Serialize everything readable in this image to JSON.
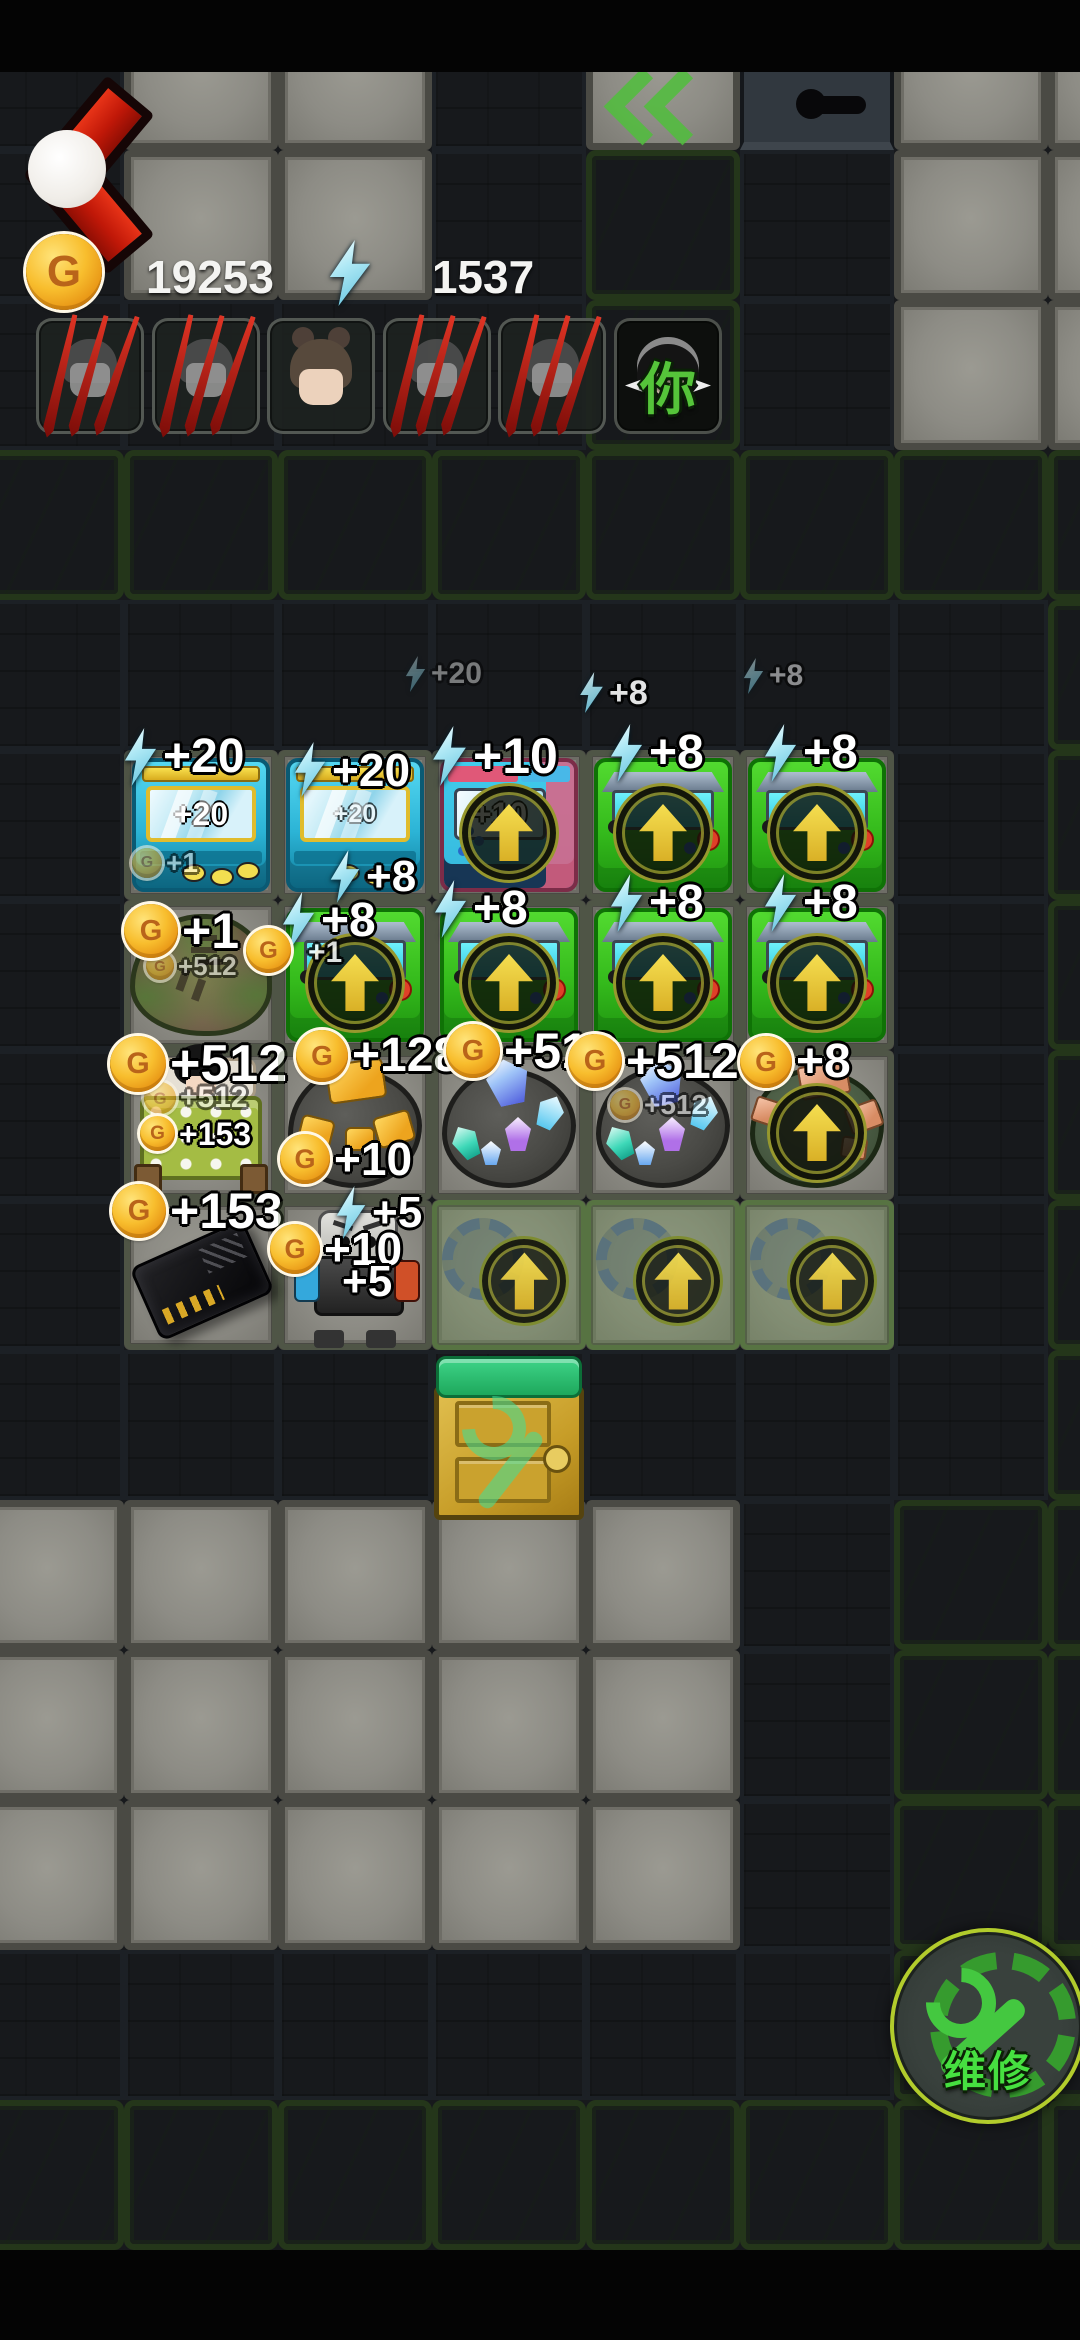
{
  "icons": {
    "coin_letter": "G"
  },
  "hud": {
    "coins": "19253",
    "energy": "1537"
  },
  "party": {
    "you_label": "你",
    "slots": [
      {
        "avatar": "ghost",
        "defeated": true
      },
      {
        "avatar": "ghost",
        "defeated": true
      },
      {
        "avatar": "girl",
        "defeated": false
      },
      {
        "avatar": "ghost",
        "defeated": true
      },
      {
        "avatar": "ghost",
        "defeated": true
      },
      {
        "avatar": "you",
        "defeated": false
      }
    ]
  },
  "map": {
    "tile_w": 154,
    "tile_h": 150,
    "origin_x": -30,
    "origin_y": 0,
    "rows": [
      "DLLDXVLL",
      "DLLDGDLL",
      "DDDDGDLL",
      "GGGGGGGG",
      "DDDDDDDG",
      "DLLLLLDG",
      "DLLLLLDG",
      "DLLLLLDG",
      "DLLLLLDG",
      "DDDDDDDG",
      "LLLLLDGG",
      "LLLLLDGG",
      "LLLLLDGG",
      "DDDDDDGG",
      "GGGGGGGG",
      "BBBBBBBB"
    ]
  },
  "grid": {
    "cells": [
      {
        "row": 1,
        "col": 1,
        "item": "arcade-cyan",
        "screen": "+20",
        "arrow": false,
        "ghost": false,
        "labels": [
          {
            "icon": "energy",
            "text": "+20",
            "dx": -2,
            "dy": -22,
            "size": 48
          }
        ],
        "overlays": [
          {
            "icon": "coin",
            "text": "+1",
            "dx": 8,
            "dy": 98,
            "size": 28,
            "faint": true
          }
        ]
      },
      {
        "row": 1,
        "col": 2,
        "item": "arcade-cyan",
        "screen": "+20",
        "screen_faint": true,
        "arrow": false,
        "ghost": false,
        "labels": [
          {
            "icon": "energy",
            "text": "+20",
            "dx": 14,
            "dy": -8,
            "size": 46
          },
          {
            "icon": "energy",
            "text": "+8",
            "dx": 50,
            "dy": 100,
            "size": 44
          }
        ],
        "overlays": []
      },
      {
        "row": 1,
        "col": 3,
        "item": "arcade-pink",
        "screen": "+10",
        "arrow": true,
        "ghost": false,
        "labels": [
          {
            "icon": "energy",
            "text": "+10",
            "dx": -2,
            "dy": -24,
            "size": 50
          }
        ],
        "overlays": []
      },
      {
        "row": 1,
        "col": 4,
        "item": "arcade-green",
        "arrow": true,
        "ghost": false,
        "labels": [
          {
            "icon": "energy",
            "text": "+8",
            "dx": 22,
            "dy": -26,
            "size": 48
          }
        ],
        "overlays": []
      },
      {
        "row": 1,
        "col": 5,
        "item": "arcade-green",
        "arrow": true,
        "ghost": false,
        "labels": [
          {
            "icon": "energy",
            "text": "+8",
            "dx": 22,
            "dy": -26,
            "size": 48
          }
        ],
        "overlays": []
      },
      {
        "row": 2,
        "col": 1,
        "item": "stump",
        "arrow": false,
        "ghost": false,
        "labels": [
          {
            "icon": "coin",
            "text": "+1",
            "dx": 0,
            "dy": 4,
            "size": 50
          }
        ],
        "overlays": [
          {
            "icon": "coin",
            "text": "+512",
            "dx": 22,
            "dy": 52,
            "size": 26,
            "faint": true
          }
        ]
      },
      {
        "row": 2,
        "col": 2,
        "item": "arcade-green",
        "arrow": true,
        "ghost": false,
        "labels": [
          {
            "icon": "energy",
            "text": "+8",
            "dx": 2,
            "dy": -8,
            "size": 48
          }
        ],
        "overlays": []
      },
      {
        "row": 2,
        "col": 3,
        "item": "arcade-green",
        "arrow": true,
        "ghost": false,
        "labels": [
          {
            "icon": "energy",
            "text": "+8",
            "dx": 0,
            "dy": -20,
            "size": 48
          }
        ],
        "overlays": []
      },
      {
        "row": 2,
        "col": 4,
        "item": "arcade-green",
        "arrow": true,
        "ghost": false,
        "labels": [
          {
            "icon": "energy",
            "text": "+8",
            "dx": 22,
            "dy": -26,
            "size": 48
          }
        ],
        "overlays": []
      },
      {
        "row": 2,
        "col": 5,
        "item": "arcade-green",
        "arrow": true,
        "ghost": false,
        "labels": [
          {
            "icon": "energy",
            "text": "+8",
            "dx": 22,
            "dy": -26,
            "size": 48
          }
        ],
        "overlays": []
      },
      {
        "row": 3,
        "col": 1,
        "item": "bed",
        "arrow": false,
        "ghost": false,
        "labels": [
          {
            "icon": "coin",
            "text": "+512",
            "dx": -14,
            "dy": -14,
            "size": 52
          }
        ],
        "overlays": [
          {
            "icon": "coin",
            "text": "+512",
            "dx": 20,
            "dy": 32,
            "size": 30,
            "faint": true
          },
          {
            "icon": "coin",
            "text": "+153",
            "dx": 16,
            "dy": 66,
            "size": 32
          }
        ]
      },
      {
        "row": 3,
        "col": 2,
        "item": "gold-rock",
        "arrow": false,
        "ghost": false,
        "labels": [
          {
            "icon": "coin",
            "text": "+128",
            "dx": 18,
            "dy": -20,
            "size": 48
          },
          {
            "icon": "coin",
            "text": "+10",
            "dx": 2,
            "dy": 84,
            "size": 46
          }
        ],
        "overlays": []
      },
      {
        "row": 3,
        "col": 3,
        "item": "crystal-rock",
        "arrow": false,
        "ghost": false,
        "labels": [
          {
            "icon": "coin",
            "text": "+512",
            "dx": 14,
            "dy": -26,
            "size": 50
          }
        ],
        "overlays": []
      },
      {
        "row": 3,
        "col": 4,
        "item": "crystal-rock",
        "arrow": false,
        "ghost": false,
        "labels": [
          {
            "icon": "coin",
            "text": "+512",
            "dx": -18,
            "dy": -16,
            "size": 50
          }
        ],
        "overlays": [
          {
            "icon": "coin",
            "text": "+512",
            "dx": 24,
            "dy": 40,
            "size": 28,
            "faint": true
          }
        ]
      },
      {
        "row": 3,
        "col": 5,
        "item": "copper-rock",
        "arrow": true,
        "ghost": false,
        "labels": [
          {
            "icon": "coin",
            "text": "+8",
            "dx": 0,
            "dy": -14,
            "size": 48
          }
        ],
        "overlays": []
      },
      {
        "row": 4,
        "col": 1,
        "item": "card",
        "arrow": false,
        "ghost": false,
        "labels": [
          {
            "icon": "coin",
            "text": "+153",
            "dx": -12,
            "dy": -16,
            "size": 50
          }
        ],
        "overlays": []
      },
      {
        "row": 4,
        "col": 2,
        "item": "robot",
        "arrow": false,
        "ghost": false,
        "labels": [
          {
            "icon": "energy",
            "text": "+5",
            "dx": 56,
            "dy": -14,
            "size": 44
          },
          {
            "icon": "coin",
            "text": "+10",
            "dx": -8,
            "dy": 24,
            "size": 46
          },
          {
            "icon": "none",
            "text": "+5",
            "dx": 64,
            "dy": 60,
            "size": 44
          }
        ],
        "overlays": []
      },
      {
        "row": 4,
        "col": 3,
        "item": "ghost",
        "arrow": true,
        "ghost": true,
        "labels": [],
        "overlays": []
      },
      {
        "row": 4,
        "col": 4,
        "item": "ghost",
        "arrow": true,
        "ghost": true,
        "labels": [],
        "overlays": []
      },
      {
        "row": 4,
        "col": 5,
        "item": "ghost",
        "arrow": true,
        "ghost": true,
        "labels": [],
        "overlays": []
      }
    ]
  },
  "particles": [
    {
      "x": 404,
      "y": 656,
      "icon": "energy",
      "text": "+20",
      "size": 30,
      "opacity": 0.42
    },
    {
      "x": 578,
      "y": 672,
      "icon": "energy",
      "text": "+8",
      "size": 34,
      "opacity": 0.88
    },
    {
      "x": 742,
      "y": 658,
      "icon": "energy",
      "text": "+8",
      "size": 30,
      "opacity": 0.5
    },
    {
      "x": 246,
      "y": 928,
      "icon": "coin",
      "text": "",
      "size": 42,
      "opacity": 1
    },
    {
      "x": 308,
      "y": 938,
      "icon": "none",
      "text": "+1",
      "size": 30,
      "opacity": 0.85
    }
  ],
  "repair_button": {
    "label": "维修"
  }
}
